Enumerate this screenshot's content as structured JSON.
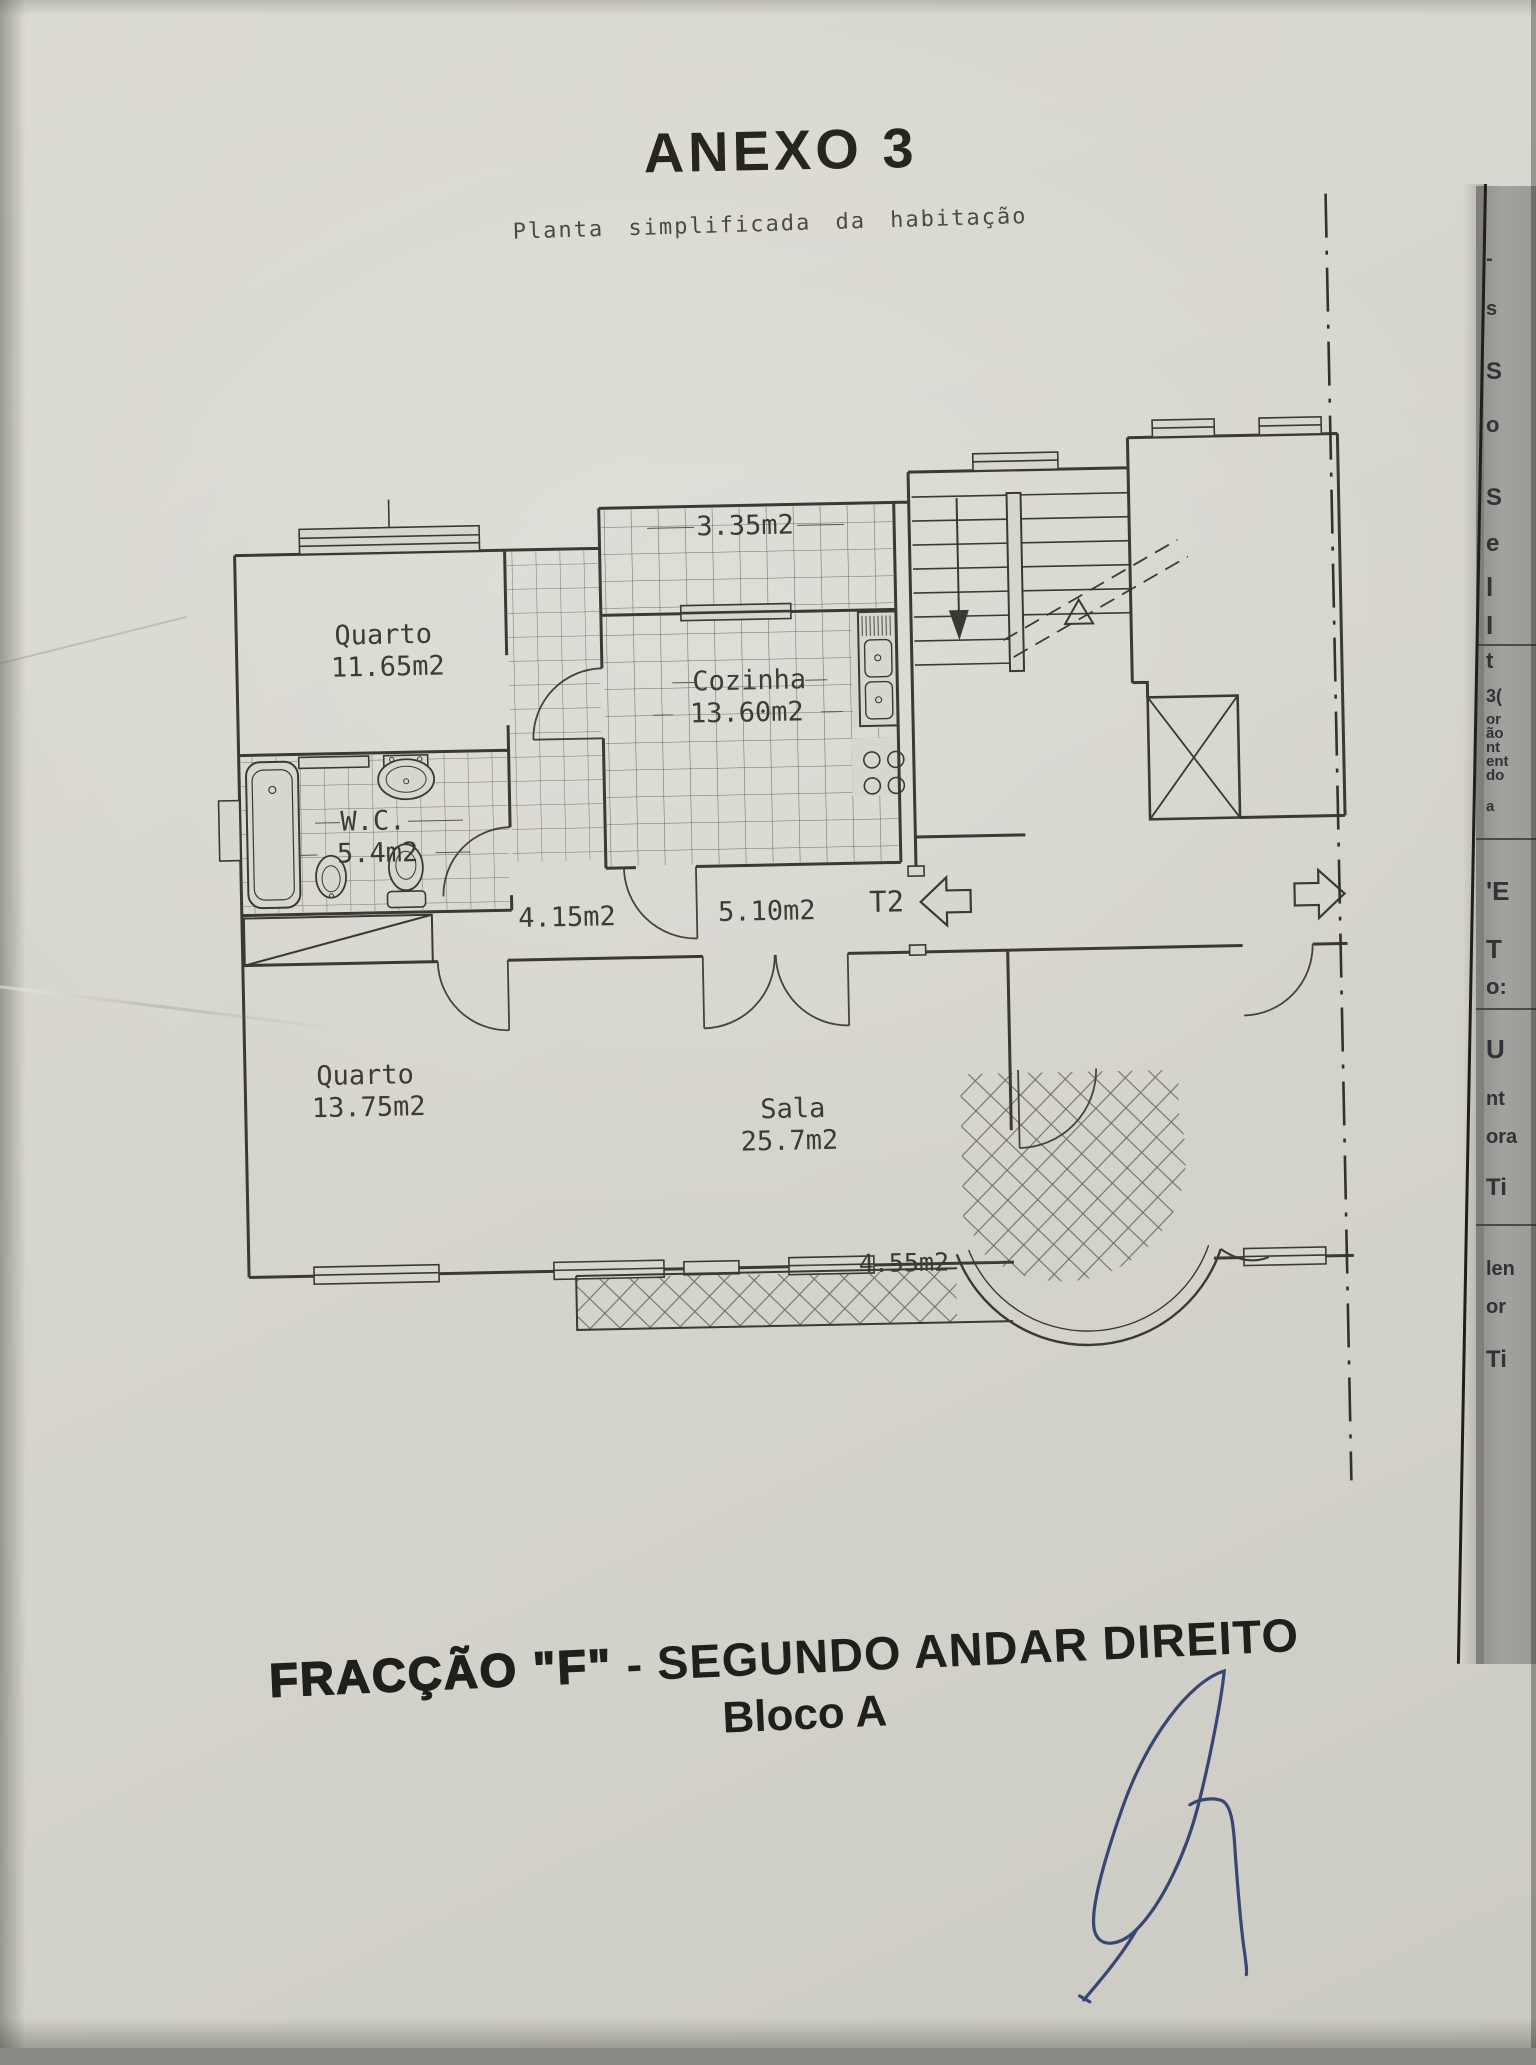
{
  "document": {
    "title": "ANEXO 3",
    "subtitle": "Planta simplificada da habitação",
    "caption_heavy": "FRACÇÃO  \"F\"",
    "caption_rest": " - SEGUNDO ANDAR DIREITO",
    "caption_line2": "Bloco A"
  },
  "plan": {
    "unit_type": "T2",
    "rooms": {
      "bedroom1": {
        "name": "Quarto",
        "area": "11.65m2"
      },
      "balcony_top": {
        "area": "3.35m2"
      },
      "kitchen": {
        "name": "Cozinha",
        "area": "13.60m2"
      },
      "wc": {
        "name": "W.C.",
        "area": "5.4m2"
      },
      "hall": {
        "area": "4.15m2"
      },
      "entry_hall": {
        "area": "5.10m2"
      },
      "bedroom2": {
        "name": "Quarto",
        "area": "13.75m2"
      },
      "living": {
        "name": "Sala",
        "area": "25.7m2"
      },
      "balcony_bottom": {
        "area": "4.55m2"
      }
    }
  },
  "underlying_page": {
    "fragments": [
      {
        "t": "-",
        "y": 62,
        "s": 20
      },
      {
        "t": "s",
        "y": 112,
        "s": 20
      },
      {
        "t": "S",
        "y": 172,
        "s": 24
      },
      {
        "t": "o",
        "y": 226,
        "s": 22
      },
      {
        "t": "S",
        "y": 298,
        "s": 24
      },
      {
        "t": "e",
        "y": 344,
        "s": 24
      },
      {
        "t": "l",
        "y": 386,
        "s": 26
      },
      {
        "t": "I",
        "y": 424,
        "s": 26
      },
      {
        "t": "t",
        "y": 462,
        "s": 22
      },
      {
        "t": "3(",
        "y": 500,
        "s": 18
      },
      {
        "t": "or",
        "y": 525,
        "s": 15
      },
      {
        "t": "ão",
        "y": 539,
        "s": 15
      },
      {
        "t": "nt",
        "y": 553,
        "s": 15
      },
      {
        "t": "ent",
        "y": 567,
        "s": 15
      },
      {
        "t": "do",
        "y": 581,
        "s": 15
      },
      {
        "t": "a",
        "y": 612,
        "s": 15
      },
      {
        "t": "'E",
        "y": 690,
        "s": 26
      },
      {
        "t": "T",
        "y": 748,
        "s": 26
      },
      {
        "t": "o:",
        "y": 788,
        "s": 22
      },
      {
        "t": "U",
        "y": 848,
        "s": 26
      },
      {
        "t": "nt",
        "y": 902,
        "s": 20
      },
      {
        "t": "ora",
        "y": 940,
        "s": 20
      },
      {
        "t": "Ti",
        "y": 988,
        "s": 24
      },
      {
        "t": "len",
        "y": 1072,
        "s": 20
      },
      {
        "t": "or",
        "y": 1110,
        "s": 20
      },
      {
        "t": "Ti",
        "y": 1160,
        "s": 24
      }
    ],
    "rules": [
      458,
      652,
      822,
      1038
    ]
  },
  "colors": {
    "paper": "#d8d7cf",
    "ink": "#3a3933",
    "title_ink": "#26261f",
    "signature_blue": "#2d3a6b",
    "under_page": "#9c9b97"
  }
}
